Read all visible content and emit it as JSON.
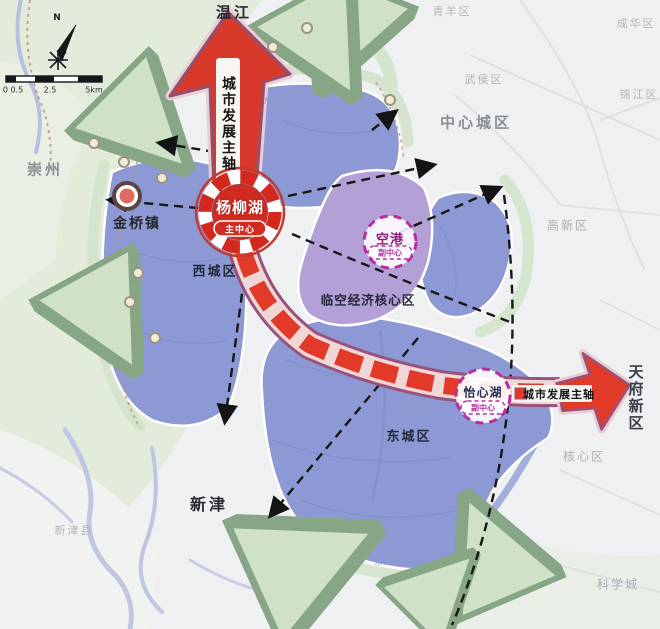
{
  "map": {
    "compass": {
      "north_label": "N"
    },
    "scalebar": {
      "tick_left": "0 0.5",
      "tick_mid": "2.5",
      "tick_right": "5km"
    },
    "axes": {
      "vertical_label": "城市发展主轴",
      "horizontal_label": "城市发展主轴"
    },
    "centers": {
      "main": {
        "name": "杨柳湖",
        "role": "主中心"
      },
      "airport": {
        "name": "空港",
        "role": "副中心"
      },
      "yixin": {
        "name": "怡心湖",
        "role": "副中心"
      }
    },
    "towns": {
      "wenjiang": "温江",
      "jinqiao": "金桥镇",
      "xinjin": "新津"
    },
    "districts": {
      "xicheng": "西城区",
      "dongcheng": "东城区",
      "linkong": "临空经济核心区"
    },
    "regions": {
      "chongzhou": "崇州",
      "qingyang": "青羊区",
      "chenghua": "成华区",
      "wuhou": "武侯区",
      "jinjiang": "锦江区",
      "zhongxin": "中心城区",
      "gaoxin": "高新区",
      "tianfu": "天府新区",
      "hexin": "核心区",
      "kexue": "科学城",
      "xinjin_county": "新津县"
    },
    "streets": {
      "jiujiang": "九江街道",
      "gongxing": "公兴镇",
      "xiehe": "协和街道",
      "yongan": "永安镇"
    },
    "colors": {
      "axis_red": "#e23a28",
      "band_outline": "#99527a",
      "subcenter_magenta": "#b92da0",
      "district_blue": "#8c99d4",
      "core_purple": "#b2a0d6",
      "greenbelt": "#cfe2c8"
    }
  }
}
